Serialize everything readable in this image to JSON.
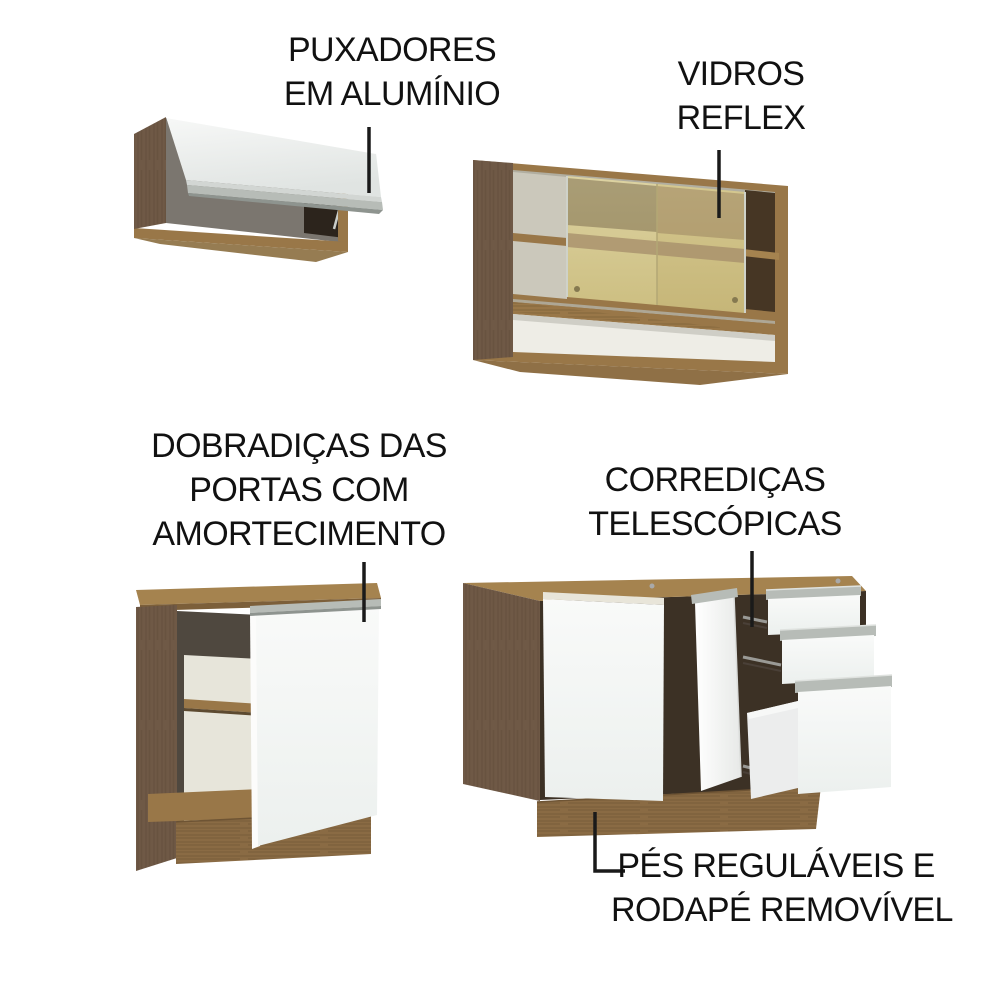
{
  "figure": {
    "kind": "kitchen-cabinet-features-diagram",
    "language": "pt-BR"
  },
  "callouts": {
    "handles": {
      "lines": [
        "PUXADORES",
        "EM ALUMÍNIO"
      ]
    },
    "glass": {
      "lines": [
        "VIDROS",
        "REFLEX"
      ]
    },
    "hinges": {
      "lines": [
        "DOBRADIÇAS DAS",
        "PORTAS COM",
        "AMORTECIMENTO"
      ]
    },
    "slides": {
      "lines": [
        "CORREDIÇAS",
        "TELESCÓPICAS"
      ]
    },
    "feet": {
      "lines": [
        "PÉS REGULÁVEIS E",
        "RODAPÉ REMOVÍVEL"
      ]
    }
  },
  "colors": {
    "background": "#ffffff",
    "text": "#111111",
    "line_color": "#1a1a1a",
    "wood_side": "#6f5946",
    "wood_front": "#997748",
    "wood_light": "#a5834f",
    "plinth": "#8a6b44",
    "aluminum": "#b7bcb7",
    "interior": "#7b766f",
    "door_white": "#f4f5f4",
    "glass": "#d2c58c",
    "glass_shelf_band": "#a8906c"
  }
}
